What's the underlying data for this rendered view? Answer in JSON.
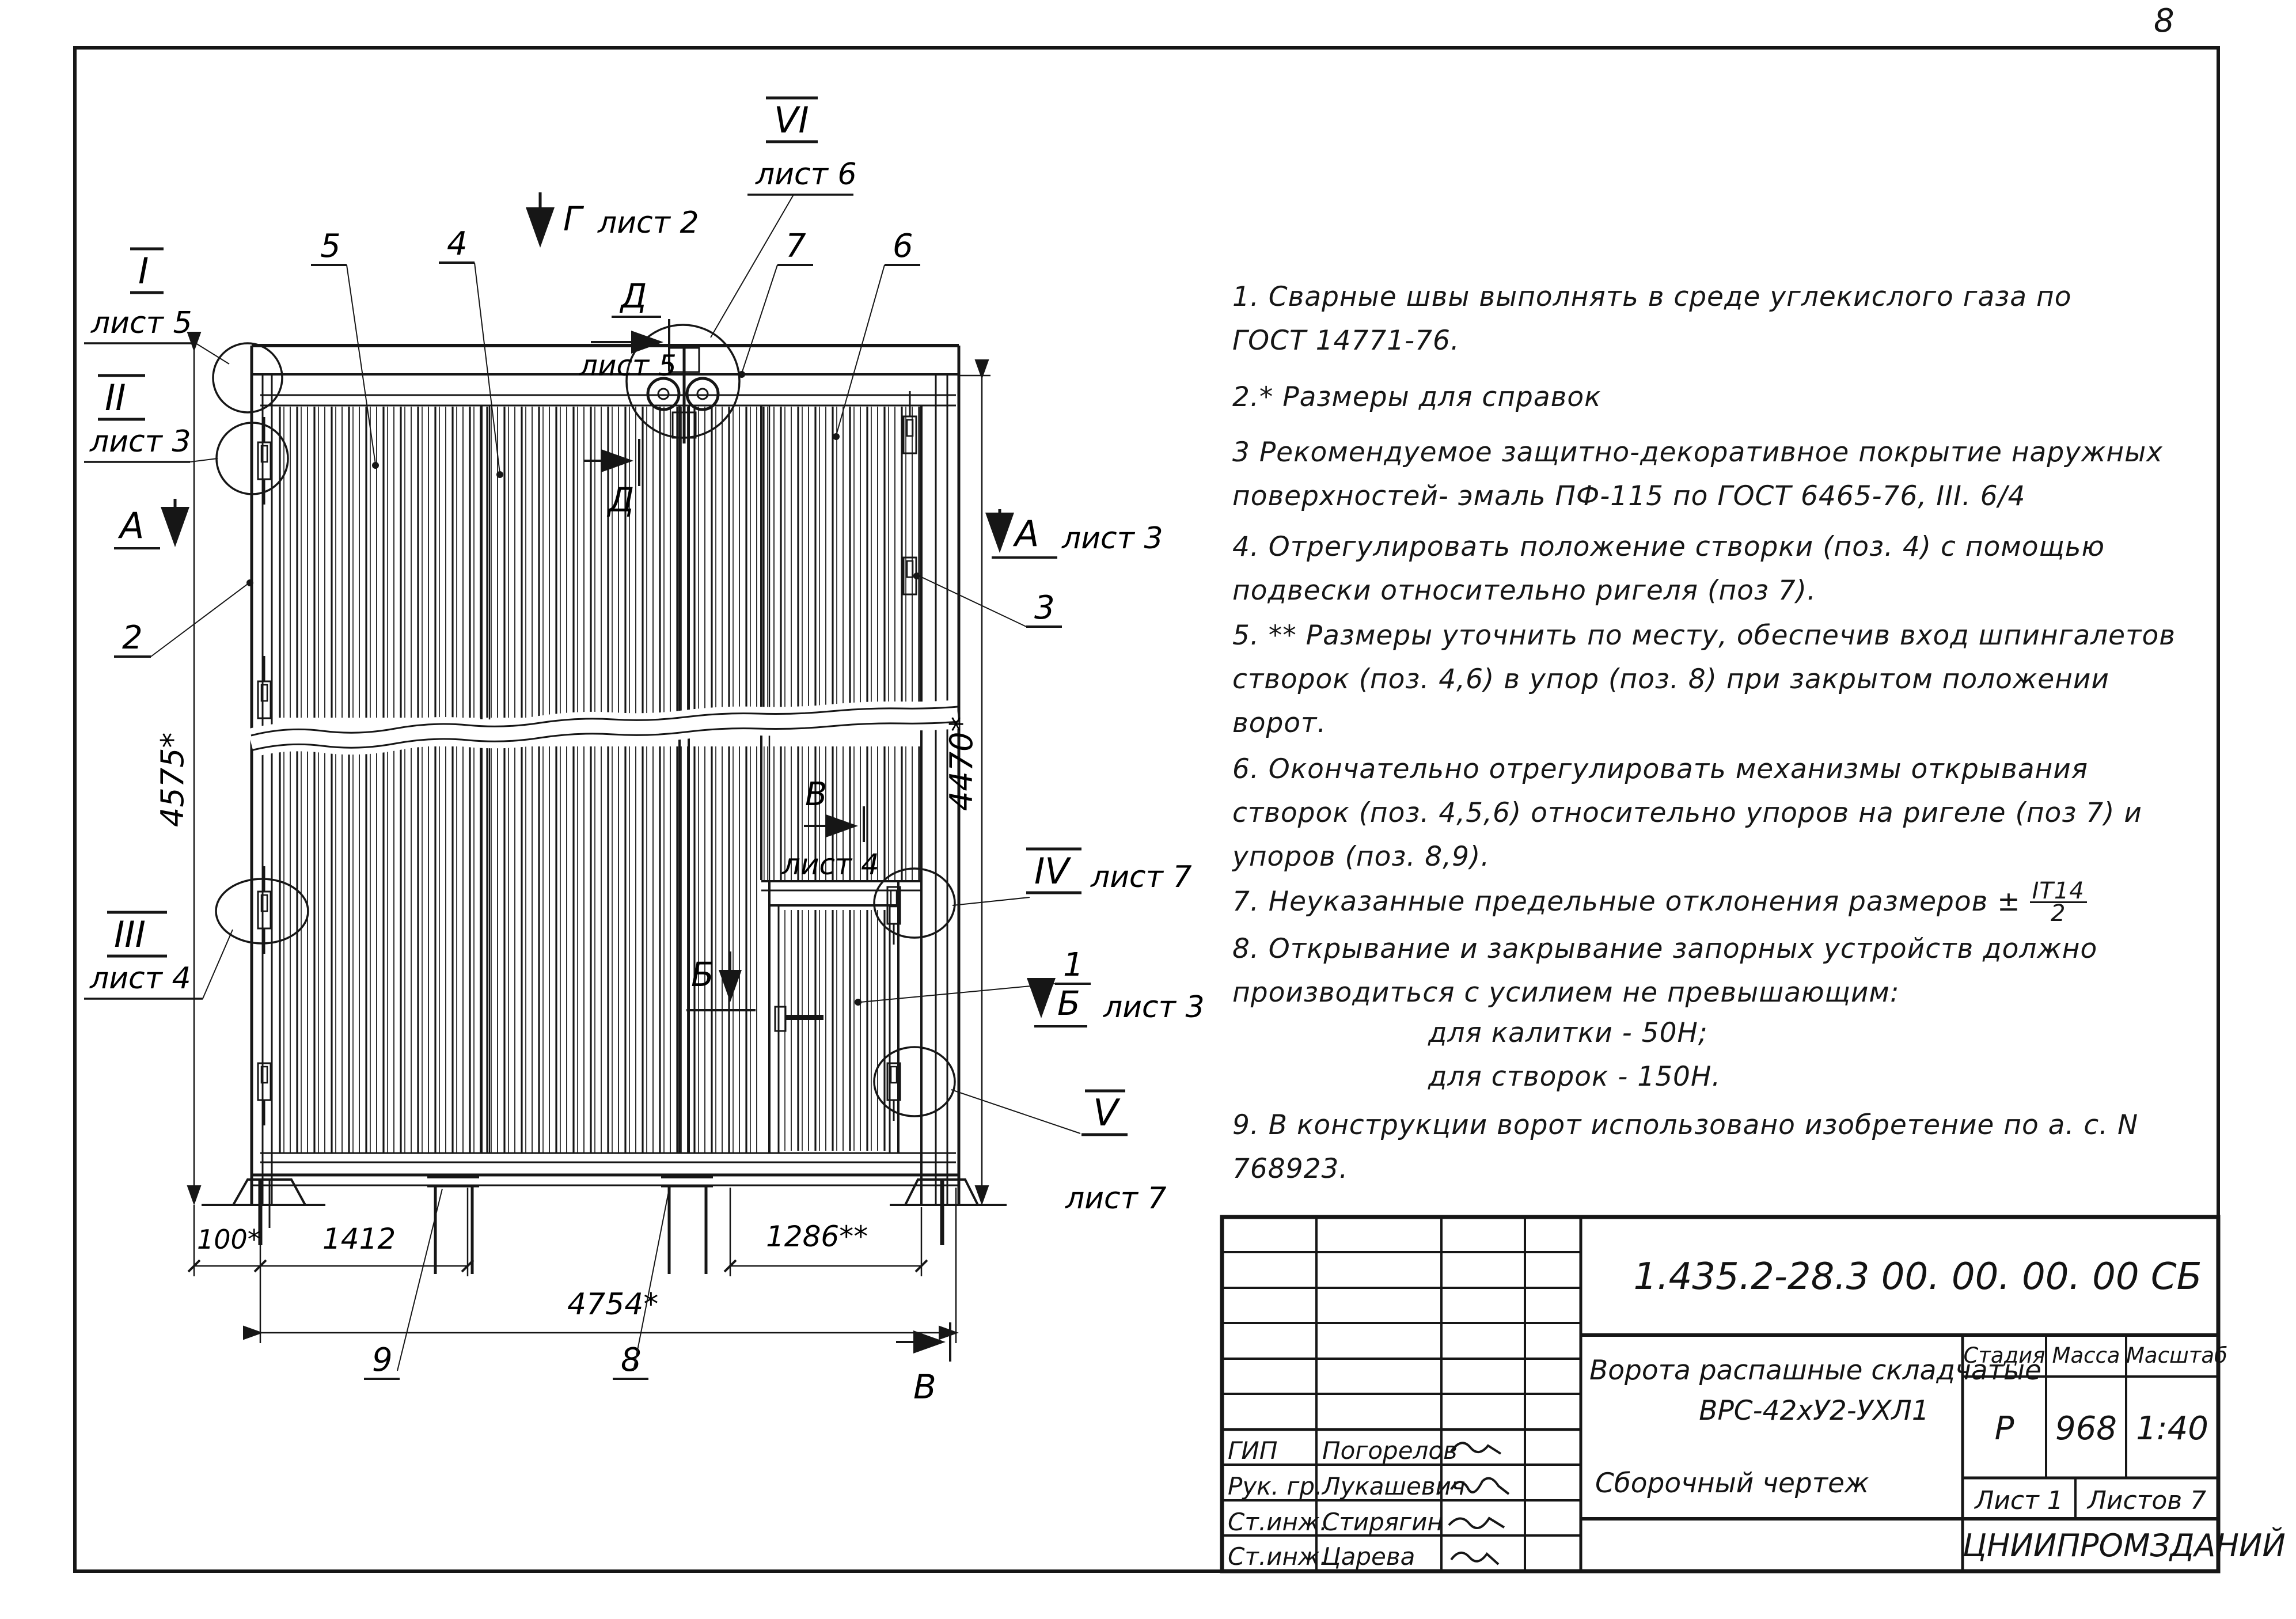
{
  "page": {
    "sheet_number": "8"
  },
  "drawing": {
    "details": {
      "I": {
        "num": "I",
        "sheet": "лист 5"
      },
      "II": {
        "num": "II",
        "sheet": "лист 3"
      },
      "III": {
        "num": "III",
        "sheet": "лист 4"
      },
      "IV": {
        "num": "IV",
        "sheet": "лист 7"
      },
      "V": {
        "num": "V",
        "sheet": "лист 7"
      },
      "VI": {
        "num": "VI",
        "sheet": "лист 6"
      }
    },
    "views": {
      "A_left": {
        "letter": "А"
      },
      "A_right": {
        "letter": "А",
        "sheet": "лист 3"
      },
      "B_inner": {
        "letter": "Б"
      },
      "B_right": {
        "letter": "Б",
        "sheet": "лист 3"
      },
      "V_inner": {
        "letter": "В",
        "sheet": "лист 4"
      },
      "V_bottom": {
        "letter": "В"
      },
      "G_top": {
        "letter": "Г",
        "sheet": "лист 2"
      },
      "D_top": {
        "letter": "Д",
        "sheet": "лист 5"
      },
      "D_bot": {
        "letter": "Д"
      }
    },
    "positions": {
      "p1": "1",
      "p2": "2",
      "p3": "3",
      "p4": "4",
      "p5": "5",
      "p6": "6",
      "p7": "7",
      "p8": "8",
      "p9": "9"
    },
    "dimensions": {
      "height_left": "4575*",
      "height_right": "4470*",
      "offset": "100*",
      "leaf": "1412",
      "wicket": "1286**",
      "total": "4754*"
    }
  },
  "notes": [
    {
      "t": "1.  Сварные  швы  выполнять  в  среде  углекислого  газа  по  ГОСТ 14771-76."
    },
    {
      "t": "2.* Размеры  для  справок"
    },
    {
      "t": "3   Рекомендуемое  защитно-декоративное  покрытие наружных  поверхностей- эмаль  ПФ-115 по ГОСТ 6465-76, III. 6/4"
    },
    {
      "t": "4.  Отрегулировать  положение  створки  (поз. 4) с помощью подвески  относительно  ригеля  (поз 7)."
    },
    {
      "t": "5. ** Размеры  уточнить  по  месту,  обеспечив  вход  шпингалетов  створок  (поз. 4,6)  в упор  (поз. 8) при закрытом положении  ворот."
    },
    {
      "t": "6.  Окончательно  отрегулировать  механизмы  открывания  створок  (поз. 4,5,6)  относительно  упоров  на ригеле  (поз 7)  и упоров  (поз. 8,9)."
    }
  ],
  "note7": {
    "prefix": "7.  Неуказанные  предельные  отклонения  размеров ±",
    "frac_num": "IT14",
    "frac_den": "2"
  },
  "note8": {
    "line1": "8.  Открывание  и  закрывание  запорных  устройств должно   производиться  с усилием  не превышающим:",
    "sub1": "для  калитки -  50Н;",
    "sub2": "для  створок  -  150Н."
  },
  "note9": {
    "t": "9.  В конструкции  ворот  использовано  изобретение по  а. с.  N 768923."
  },
  "title_block": {
    "doc_number": "1.435.2-28.3 00. 00. 00. 00  СБ",
    "title_line1": "Ворота распашные складчатые",
    "title_line2": "ВРС-42хУ2-УХЛ1",
    "title_line3": "Сборочный  чертеж",
    "stage_label": "Стадия",
    "mass_label": "Масса",
    "scale_label": "Масштаб",
    "stage": "Р",
    "mass": "968",
    "scale": "1:40",
    "sheet_label": "Лист 1",
    "sheets_label": "Листов 7",
    "org": "ЦНИИПРОМЗДАНИЙ",
    "rows": [
      {
        "role": "ГИП",
        "name": "Погорелов"
      },
      {
        "role": "Рук. гр.",
        "name": "Лукашевич"
      },
      {
        "role": "Ст.инж.",
        "name": "Стирягин"
      },
      {
        "role": "Ст.инж.",
        "name": "Царева"
      }
    ]
  }
}
